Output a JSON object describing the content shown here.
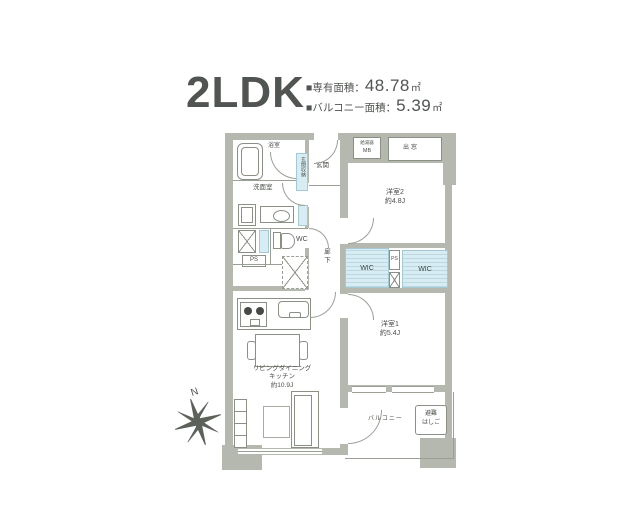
{
  "header": {
    "type": "2LDK",
    "area_label": "■専有面積：",
    "area_value": "48.78",
    "area_unit": "㎡",
    "balcony_label": "■バルコニー面積：",
    "balcony_value": "5.39",
    "balcony_unit": "㎡"
  },
  "plan": {
    "bathroom": "浴室",
    "entrance_storage": "玄関収納",
    "entrance": "玄関",
    "water_heater": "給湯器",
    "meter_box": "MB",
    "bay_window": "出窓",
    "washroom": "洗面室",
    "wc": "WC",
    "ps_left": "PS",
    "ps_center": "PS",
    "hallway": "廊下",
    "room2_name": "洋室2",
    "room2_size": "約4.8J",
    "wic_left": "WIC",
    "wic_right": "WIC",
    "room1_name": "洋室1",
    "room1_size": "約5.4J",
    "ldk_name_line1": "リビングダイニング",
    "ldk_name_line2": "キッチン",
    "ldk_size": "約10.9J",
    "balcony": "バルコニー",
    "ladder_line1": "避難",
    "ladder_line2": "はしご",
    "compass_north": "N"
  },
  "colors": {
    "wall": "#b4b8ae",
    "line": "#9aa096",
    "highlight": "#d8edf3",
    "text": "#4b4f4b"
  }
}
